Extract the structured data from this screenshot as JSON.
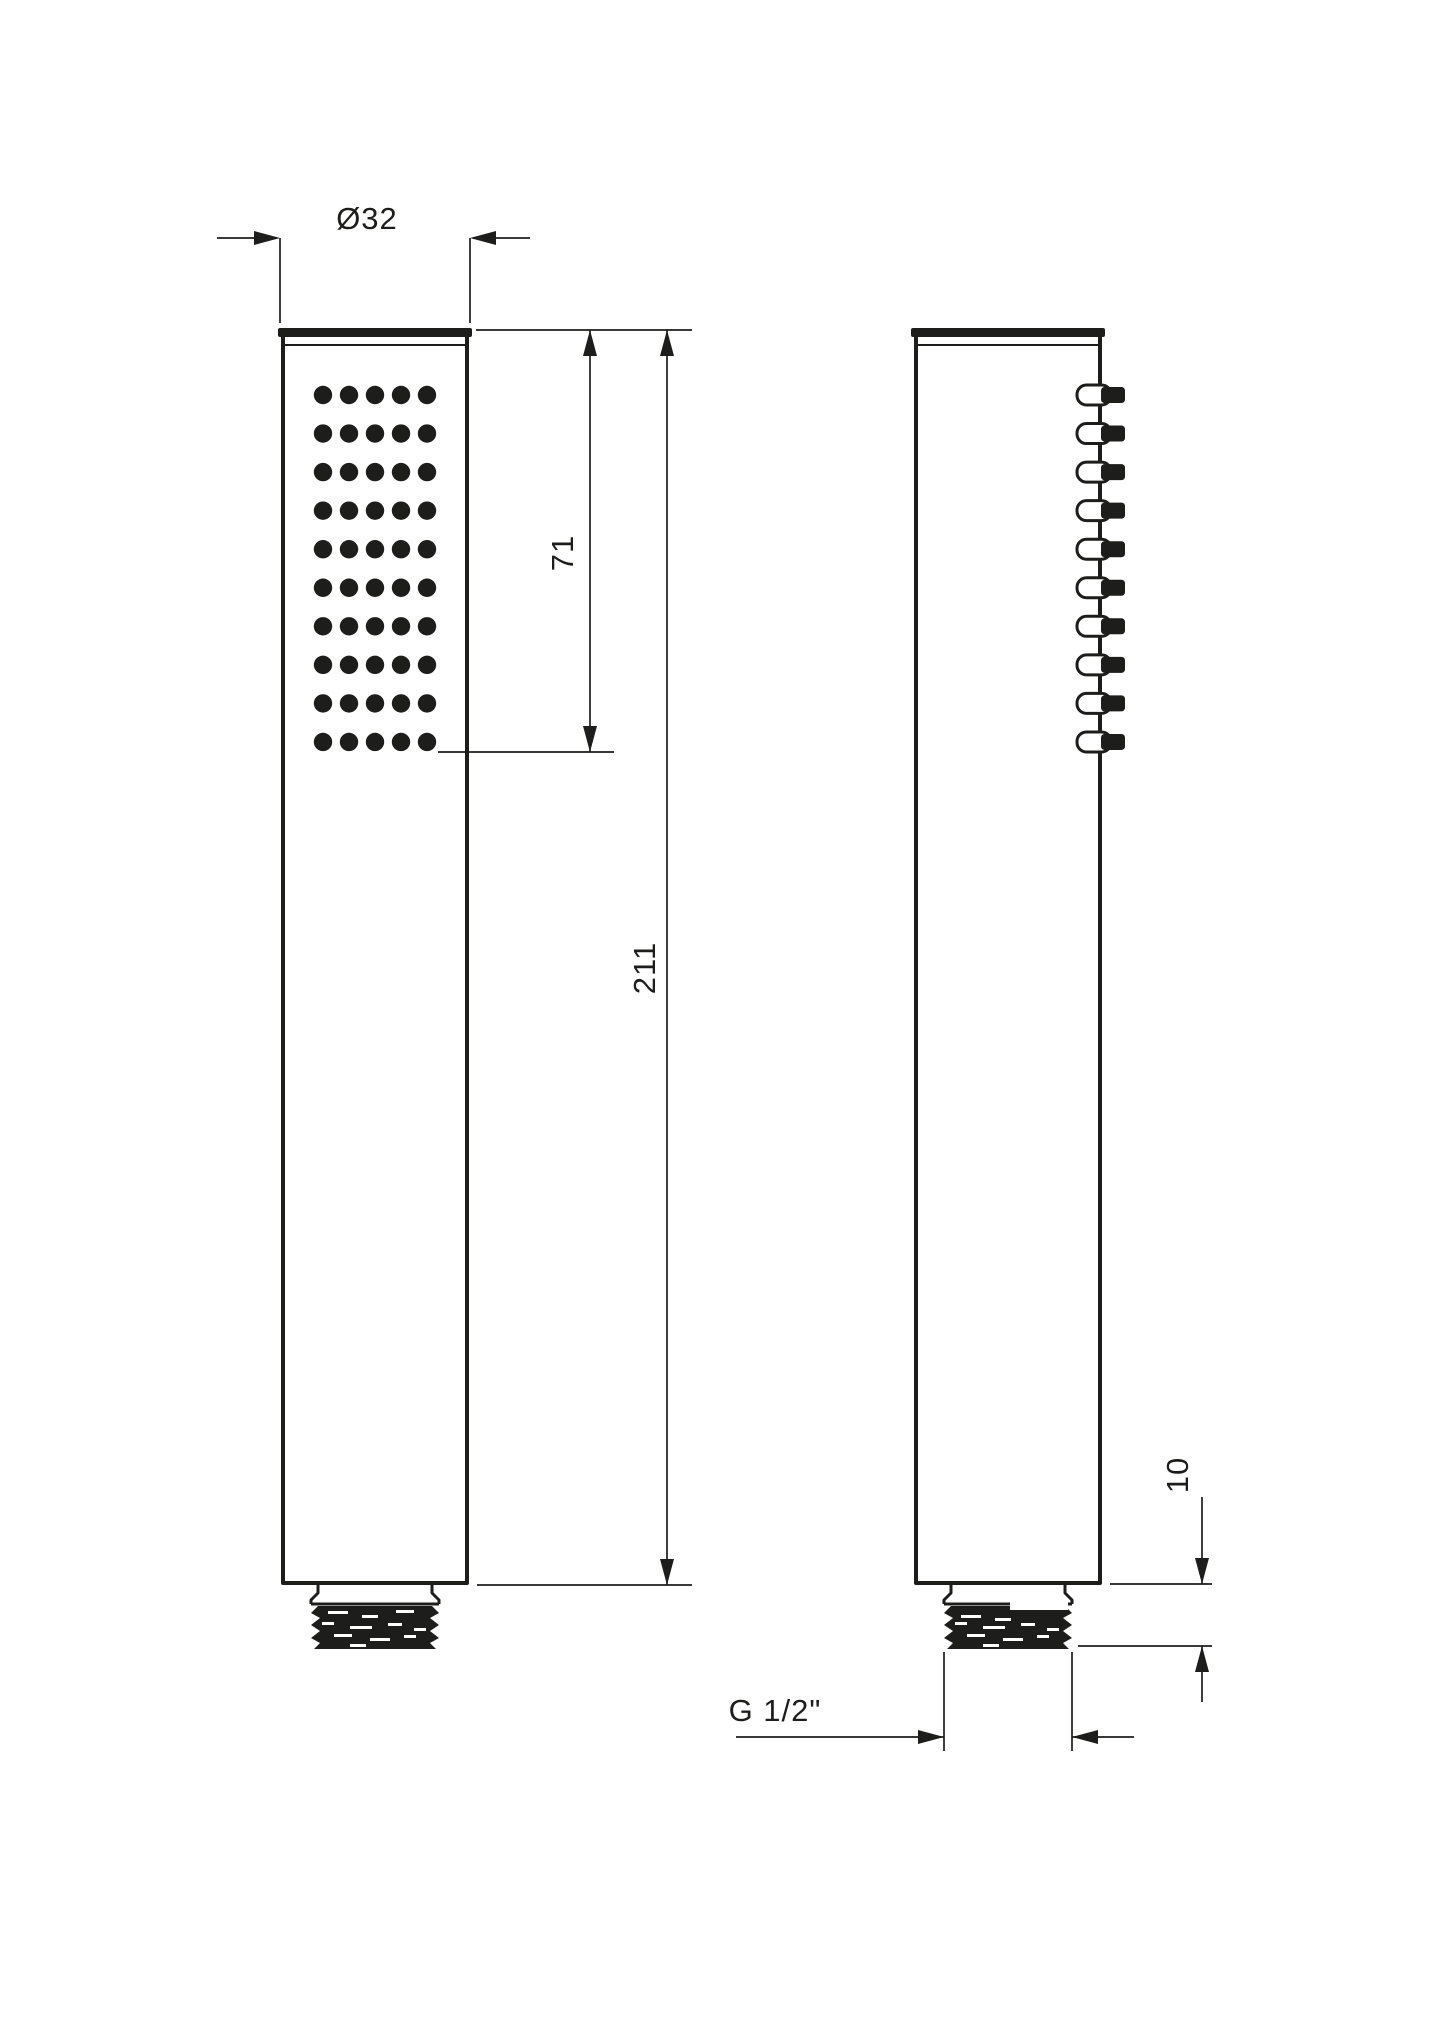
{
  "page": {
    "background": "#ffffff",
    "ink_color": "#1d1d1b"
  },
  "drawing": {
    "type": "technical-orthographic",
    "subject": "handheld shower head, two views with dimensions",
    "views": {
      "front": {
        "nozzle_rows": 10,
        "nozzle_cols": 5
      },
      "side": {
        "nozzle_count": 10
      }
    },
    "labels": {
      "diameter": "Ø32",
      "face_length": "71",
      "total_length": "211",
      "thread_length": "10",
      "thread_spec": "G 1/2\""
    }
  }
}
